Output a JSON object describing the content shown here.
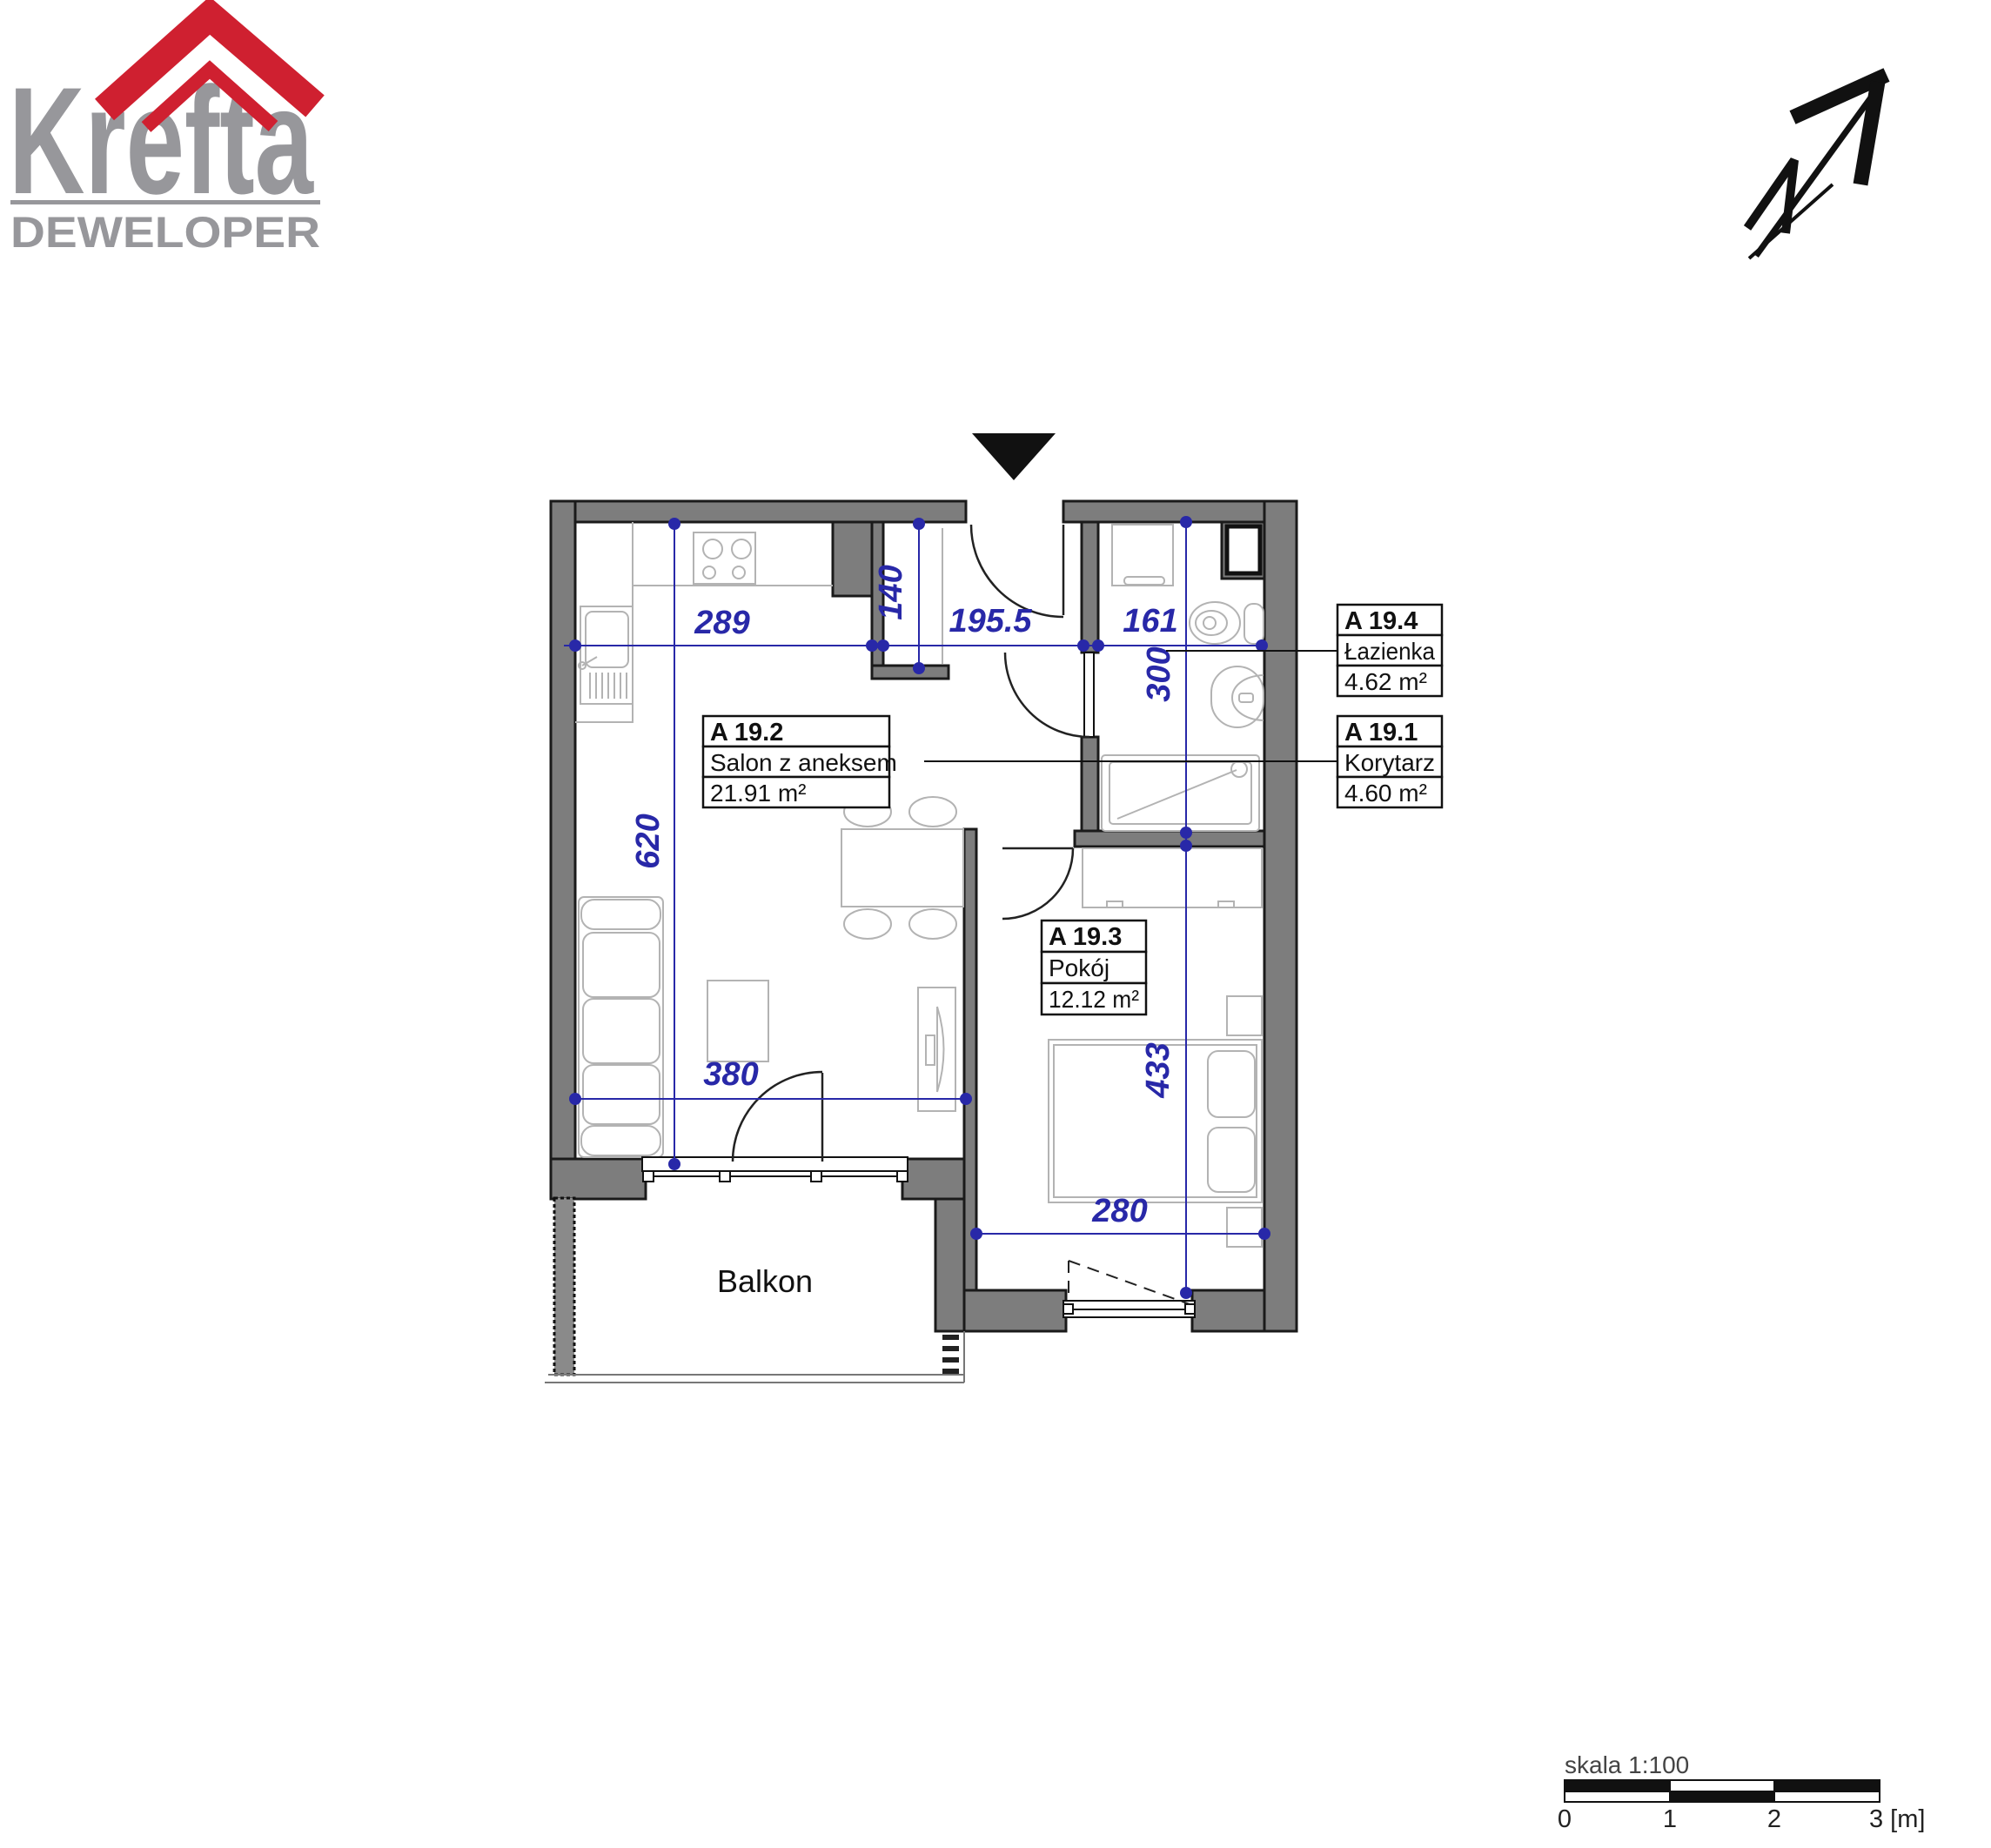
{
  "logo": {
    "brand": "Krefta",
    "subtitle": "DEWELOPER"
  },
  "plan": {
    "rooms": [
      {
        "id": "A 19.2",
        "name": "Salon z aneksem",
        "area": "21.91 m²"
      },
      {
        "id": "A 19.3",
        "name": "Pokój",
        "area": "12.12 m²"
      },
      {
        "id": "A 19.4",
        "name": "Łazienka",
        "area": "4.62 m²"
      },
      {
        "id": "A 19.1",
        "name": "Korytarz",
        "area": "4.60 m²"
      }
    ],
    "balcony_label": "Balkon",
    "dimensions": {
      "kitchen_width": "289",
      "hall_stub_depth": "140",
      "hall_width": "195.5",
      "bath_width": "161",
      "bath_depth": "300",
      "salon_depth": "620",
      "salon_width": "380",
      "room_depth": "433",
      "room_width": "280"
    }
  },
  "scale_bar": {
    "label": "skala 1:100",
    "ticks": [
      "0",
      "1",
      "2",
      "3 [m]"
    ]
  },
  "colors": {
    "wall_gray": "#7d7d7d",
    "dimension_blue": "#2828a8",
    "logo_gray": "#97979b",
    "logo_red": "#cf2030"
  }
}
